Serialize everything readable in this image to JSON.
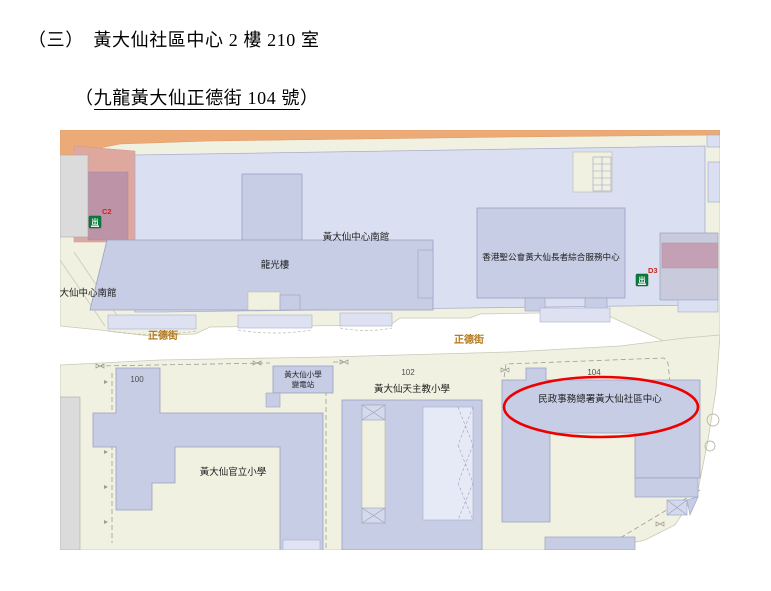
{
  "header": {
    "line1": "（三）　黃大仙社區中心 2 樓 210 室",
    "line2_open": "（",
    "line2_underlined": "九龍黃大仙正德街 104 號",
    "line2_close": "）"
  },
  "map": {
    "street_name": "正德街",
    "street_numbers": {
      "n100": "100",
      "n102": "102",
      "n104": "104"
    },
    "exits": {
      "c2": {
        "code": "C2",
        "glyph": "出"
      },
      "d3": {
        "code": "D3",
        "glyph": "出"
      }
    },
    "labels": {
      "south_annex_top": "黃大仙中心南館",
      "south_annex_left": "黃大仙中心南館",
      "lung_kwong_house": "龍光樓",
      "elderly_centre": "香港聖公會黃大仙長者綜合服務中心",
      "substation_line1": "黃大仙小學",
      "substation_line2": "變電站",
      "catholic_school": "黃大仙天主教小學",
      "govt_school": "黃大仙官立小學",
      "community_centre": "民政事務總署黃大仙社區中心"
    },
    "colors": {
      "map_bg": "#F1F1E2",
      "building_light": "#DBDFF2",
      "building_mid": "#C7CDE5",
      "road_orange": "#ECAA76",
      "mauve_block": "#C4A0B4",
      "exit_green": "#0C7B3D",
      "exit_code_red": "#CC2418",
      "street_label_brown": "#B5791E",
      "highlight_red": "#EC0000"
    }
  }
}
